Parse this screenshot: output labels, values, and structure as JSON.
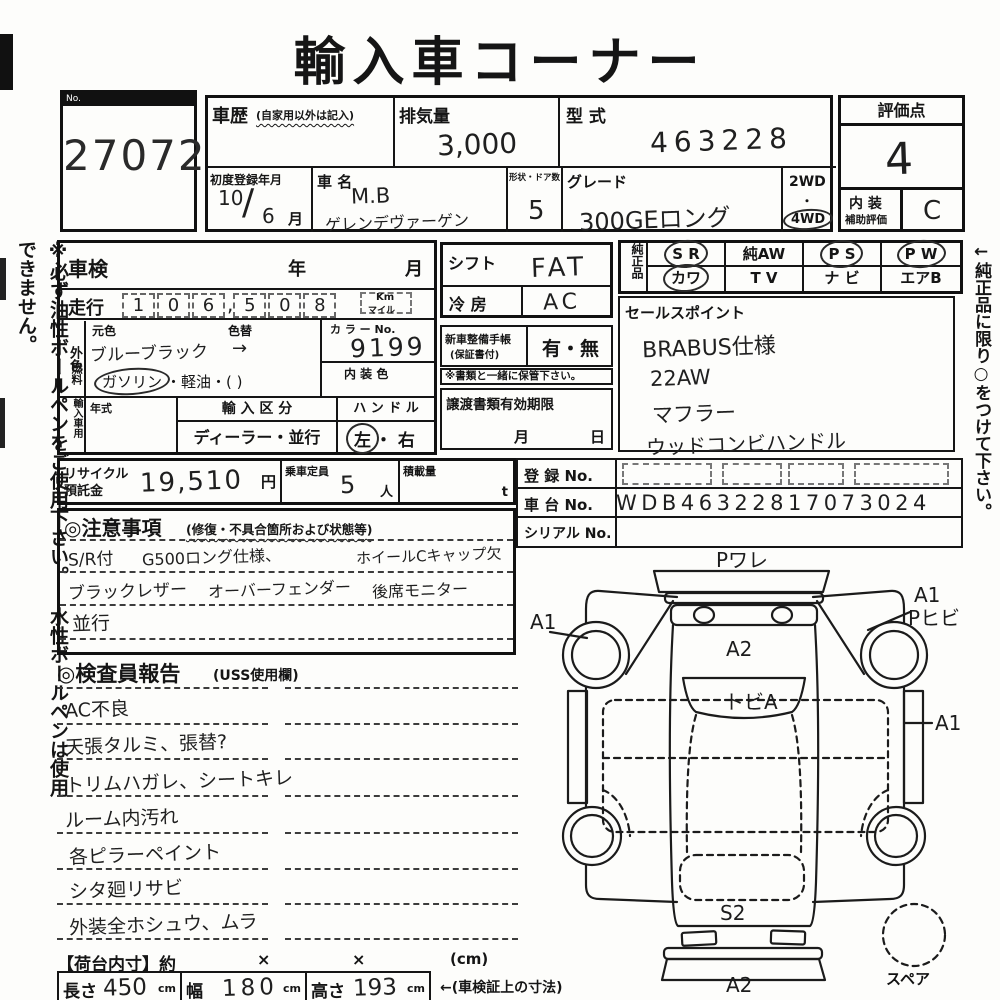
{
  "colors": {
    "ink": "#1a1a1a",
    "paper": "#fdfdfb"
  },
  "title": "輸入車コーナー",
  "lot": {
    "no_label": "No.",
    "number": "27072"
  },
  "side_notes": {
    "left": "※必ず油性ボールペンをご使用下さい。 水性ボールペンは使用できません。",
    "right": "←純正品に限り○をつけて下さい。"
  },
  "top_table": {
    "history_label": "車歴",
    "history_sub": "(自家用以外は記入)",
    "displacement_label": "排気量",
    "displacement_value": "3,000",
    "model_code_label": "型 式",
    "model_code_value": "463228",
    "first_reg_label": "初度登録年月",
    "first_reg_year": "10",
    "first_reg_slash": "/",
    "first_reg_month": "6",
    "first_reg_month_unit": "月",
    "car_name_label": "車 名",
    "car_name_line1": "M.B",
    "car_name_line2": "ゲレンデヴァーゲン",
    "doors_label": "形状・ドア数",
    "doors_value": "5",
    "grade_label": "グレード",
    "grade_value": "300GEロング",
    "wd2": "2WD",
    "dot": "・",
    "wd4": "4WD"
  },
  "score_box": {
    "score_label": "評価点",
    "score_value": "4",
    "interior_label1": "内 装",
    "interior_label2": "補助評価",
    "interior_value": "C"
  },
  "inspection_table": {
    "shaken_label": "車検",
    "year_label": "年",
    "month_label": "月",
    "mileage_label": "走行",
    "digits": [
      "1",
      "0",
      "6",
      "5",
      "0",
      "8"
    ],
    "comma": ",",
    "km_label": "Km",
    "mile_label": "マイル",
    "ext_color_label": "外色",
    "orig_color_label": "元色",
    "orig_color_value": "ブルーブラック",
    "color_change_label": "色替",
    "color_change_value": "→",
    "color_no_label": "カ ラ ー No.",
    "color_no_value": "9199",
    "fuel_label": "燃料",
    "fuel_circled": "ガソリン",
    "fuel_rest": "・軽油・(        )",
    "interior_color_label": "内 装 色",
    "import_label": "輸入車用",
    "year_type_label": "年式",
    "import_class_label": "輸 入 区 分",
    "import_class_value": "ディーラー・並行",
    "handle_label": "ハ ン ド ル",
    "handle_left": "左",
    "handle_dot": "・",
    "handle_right": "右"
  },
  "shift_box": {
    "shift_label": "シフト",
    "shift_value": "FAT",
    "ac_label": "冷 房",
    "ac_value": "AC"
  },
  "techo_box": {
    "label1": "新車整備手帳",
    "label2": "(保証書付)",
    "value": "有・無",
    "note": "※書類と一緒に保管下さい。"
  },
  "transfer_box": {
    "label": "譲渡書類有効期限",
    "month": "月",
    "day": "日"
  },
  "genuine": {
    "label": "純正品",
    "items": [
      {
        "label": "S R",
        "circled": true
      },
      {
        "label": "純AW",
        "circled": false
      },
      {
        "label": "P S",
        "circled": true
      },
      {
        "label": "P W",
        "circled": true
      },
      {
        "label": "カワ",
        "circled": true
      },
      {
        "label": "T V",
        "circled": false
      },
      {
        "label": "ナ ビ",
        "circled": false
      },
      {
        "label": "エアB",
        "circled": false
      }
    ]
  },
  "sales_points": {
    "label": "セールスポイント",
    "lines": [
      "BRABUS仕様",
      "22AW",
      "マフラー",
      "ウッドコンビハンドル"
    ]
  },
  "registration": {
    "reg_label": "登 録 No.",
    "chassis_label": "車 台 No.",
    "chassis_value": "WDB46322817073024",
    "serial_label": "シリアル No."
  },
  "recycle_row": {
    "recycle_label1": "リサイクル",
    "recycle_label2": "預託金",
    "recycle_value": "19,510",
    "yen": "円",
    "capacity_label": "乗車定員",
    "capacity_value": "5",
    "nin": "人",
    "load_label": "積載量",
    "ton": "t"
  },
  "cautions": {
    "title": "◎注意事項",
    "subtitle": "(修復・不具合箇所および状態等)",
    "row1": [
      "S/R付",
      "G500ロング仕様、",
      "ホイールCキャップ欠"
    ],
    "row2": [
      "ブラックレザー",
      "オーバーフェンダー",
      "後席モニター"
    ],
    "row3": [
      "並行"
    ]
  },
  "inspector_report": {
    "title": "◎検査員報告",
    "subtitle": "(USS使用欄)",
    "lines": [
      "AC不良",
      "天張タルミ、張替?",
      "トリムハガレ、シートキレ",
      "ルーム内汚れ",
      "各ピラーペイント",
      "シタ廻リサビ",
      "外装全ホシュウ、ムラ"
    ]
  },
  "cargo": {
    "label": "【荷台内寸】約",
    "x1": "×",
    "x2": "×",
    "cm": "(cm)",
    "length_label": "長さ",
    "length_value": "450",
    "length_unit": "cm",
    "width_label": "幅",
    "width_value": "180",
    "width_unit": "cm",
    "height_label": "高さ",
    "height_value": "193",
    "height_unit": "cm",
    "note": "←(車検証上の寸法)"
  },
  "diagram": {
    "front_bumper": "Pワレ",
    "hood": "A2",
    "windshield": "トビA",
    "left_front": "A1",
    "right_front": "A1",
    "right_front2": "Pヒビ",
    "right_side": "A1",
    "rear": "S2",
    "rear_bumper": "A2",
    "spare": "スペア"
  }
}
